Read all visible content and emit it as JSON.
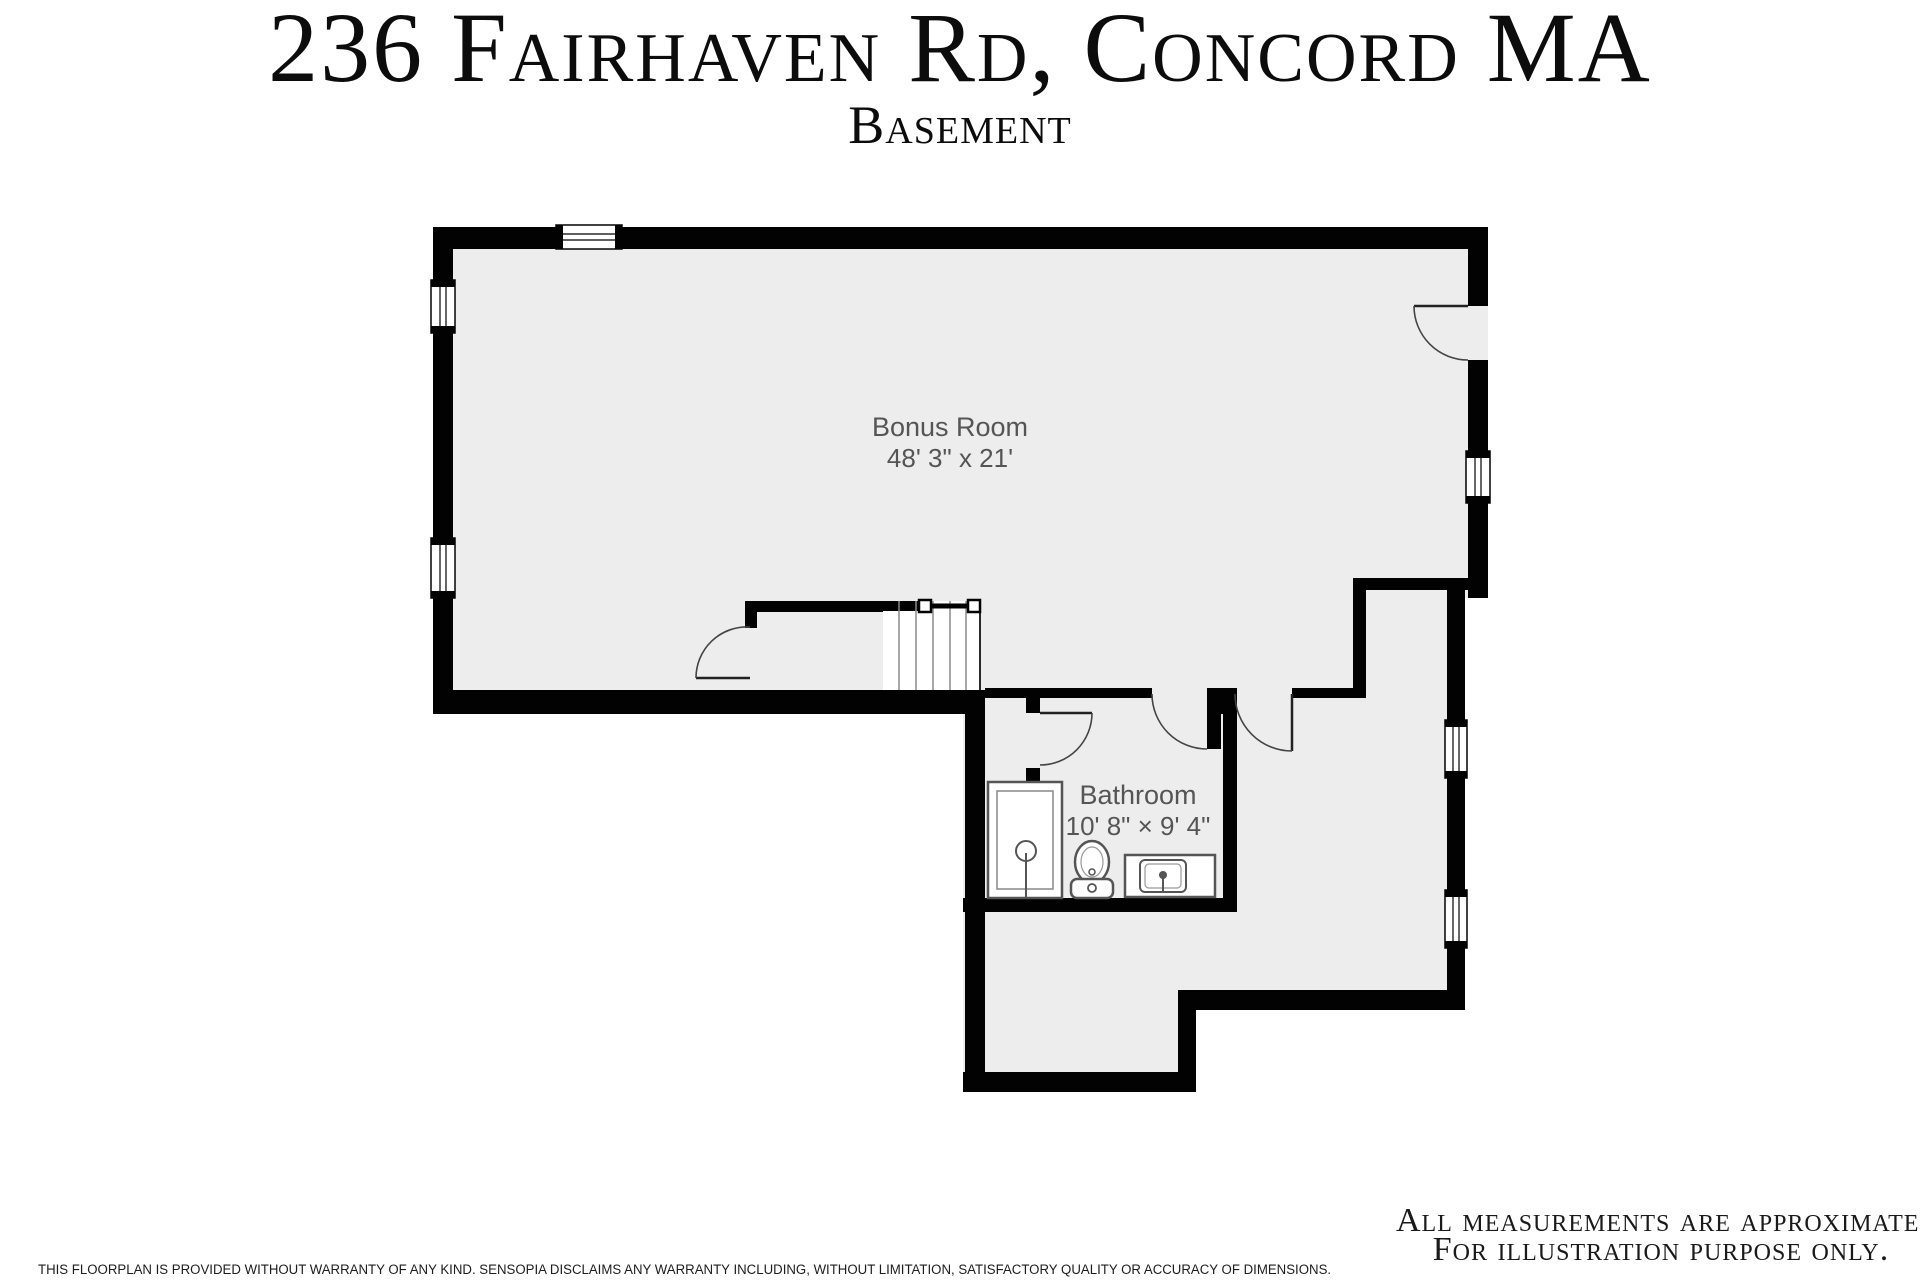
{
  "header": {
    "title": "236 Fairhaven Rd, Concord MA",
    "subtitle": "Basement"
  },
  "rooms": {
    "bonus_room": {
      "name": "Bonus Room",
      "dimensions": "48' 3\" x 21'"
    },
    "bathroom": {
      "name": "Bathroom",
      "dimensions": "10' 8\" × 9' 4\""
    }
  },
  "fixtures": [
    "shower",
    "toilet",
    "sink-vanity",
    "stairs",
    "handrail"
  ],
  "footer": {
    "disclaimer": "THIS FLOORPLAN IS PROVIDED WITHOUT WARRANTY OF ANY KIND. SENSOPIA DISCLAIMS ANY WARRANTY INCLUDING, WITHOUT LIMITATION, SATISFACTORY QUALITY OR ACCURACY OF DIMENSIONS.",
    "note_line1": "All measurements are approximate.",
    "note_line2": "For illustration purpose only."
  },
  "colors": {
    "wall": "#020202",
    "floor": "#ededed",
    "background": "#ffffff",
    "label_text": "#555555",
    "fixture_stroke": "#555555",
    "door_arc": "#444444"
  }
}
